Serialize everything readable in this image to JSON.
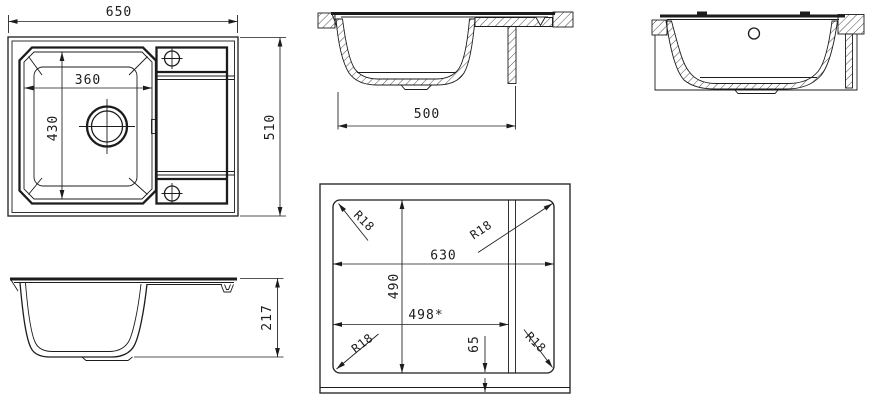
{
  "drawing": {
    "colors": {
      "line": "#1c1c1c",
      "background": "#ffffff"
    },
    "plan_view": {
      "overall_width": "650",
      "overall_depth": "510",
      "bowl_width": "360",
      "bowl_depth": "430"
    },
    "front_section_view": {
      "cutout_width": "500"
    },
    "side_elevation_view": {
      "overall_height": "217"
    },
    "cutout_template_view": {
      "cutout_length": "630",
      "cutout_depth": "490",
      "alt_cutout_length": "498*",
      "front_edge_offset": "65",
      "radii": [
        "R18",
        "R18",
        "R18",
        "R18"
      ]
    }
  }
}
